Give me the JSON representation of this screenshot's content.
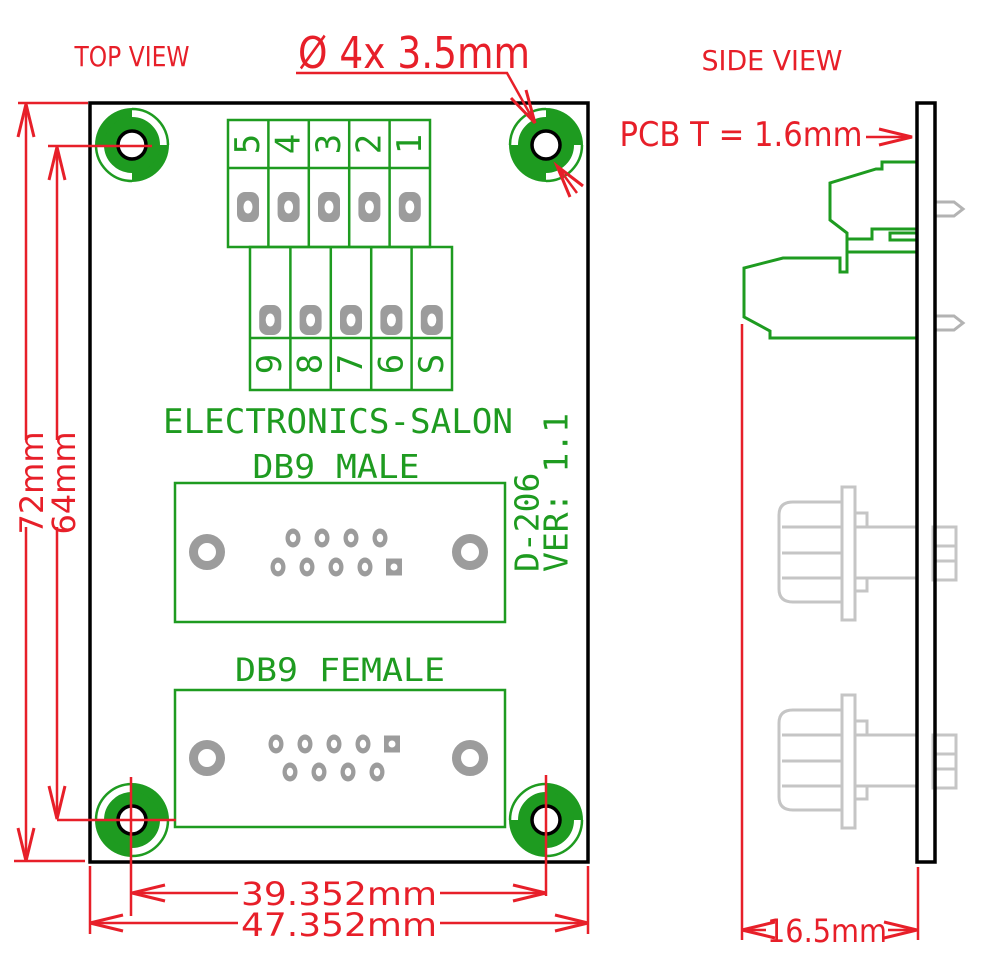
{
  "titles": {
    "top_view": "TOP VIEW",
    "side_view": "SIDE VIEW"
  },
  "annotations": {
    "hole_note": "Ø 4x 3.5mm",
    "pcb_thickness": "PCB T = 1.6mm"
  },
  "dimensions": {
    "board_height": "72mm",
    "hole_spacing_vertical": "64mm",
    "hole_spacing_horizontal": "39.352mm",
    "board_width": "47.352mm",
    "side_depth": "16.5mm"
  },
  "board": {
    "brand": "ELECTRONICS-SALON",
    "db9_male_label": "DB9 MALE",
    "db9_female_label": "DB9 FEMALE",
    "model": "D-206",
    "version": "VER: 1.1",
    "terminal_row_top": [
      "5",
      "4",
      "3",
      "2",
      "1"
    ],
    "terminal_row_bottom": [
      "9",
      "8",
      "7",
      "6",
      "S"
    ]
  },
  "colors": {
    "dimension_red": "#e71f29",
    "silkscreen_green": "#1e9b20",
    "pad_gray": "#9c9c9c",
    "connector_gray": "#c5c5c5",
    "outline_black": "#000000"
  }
}
